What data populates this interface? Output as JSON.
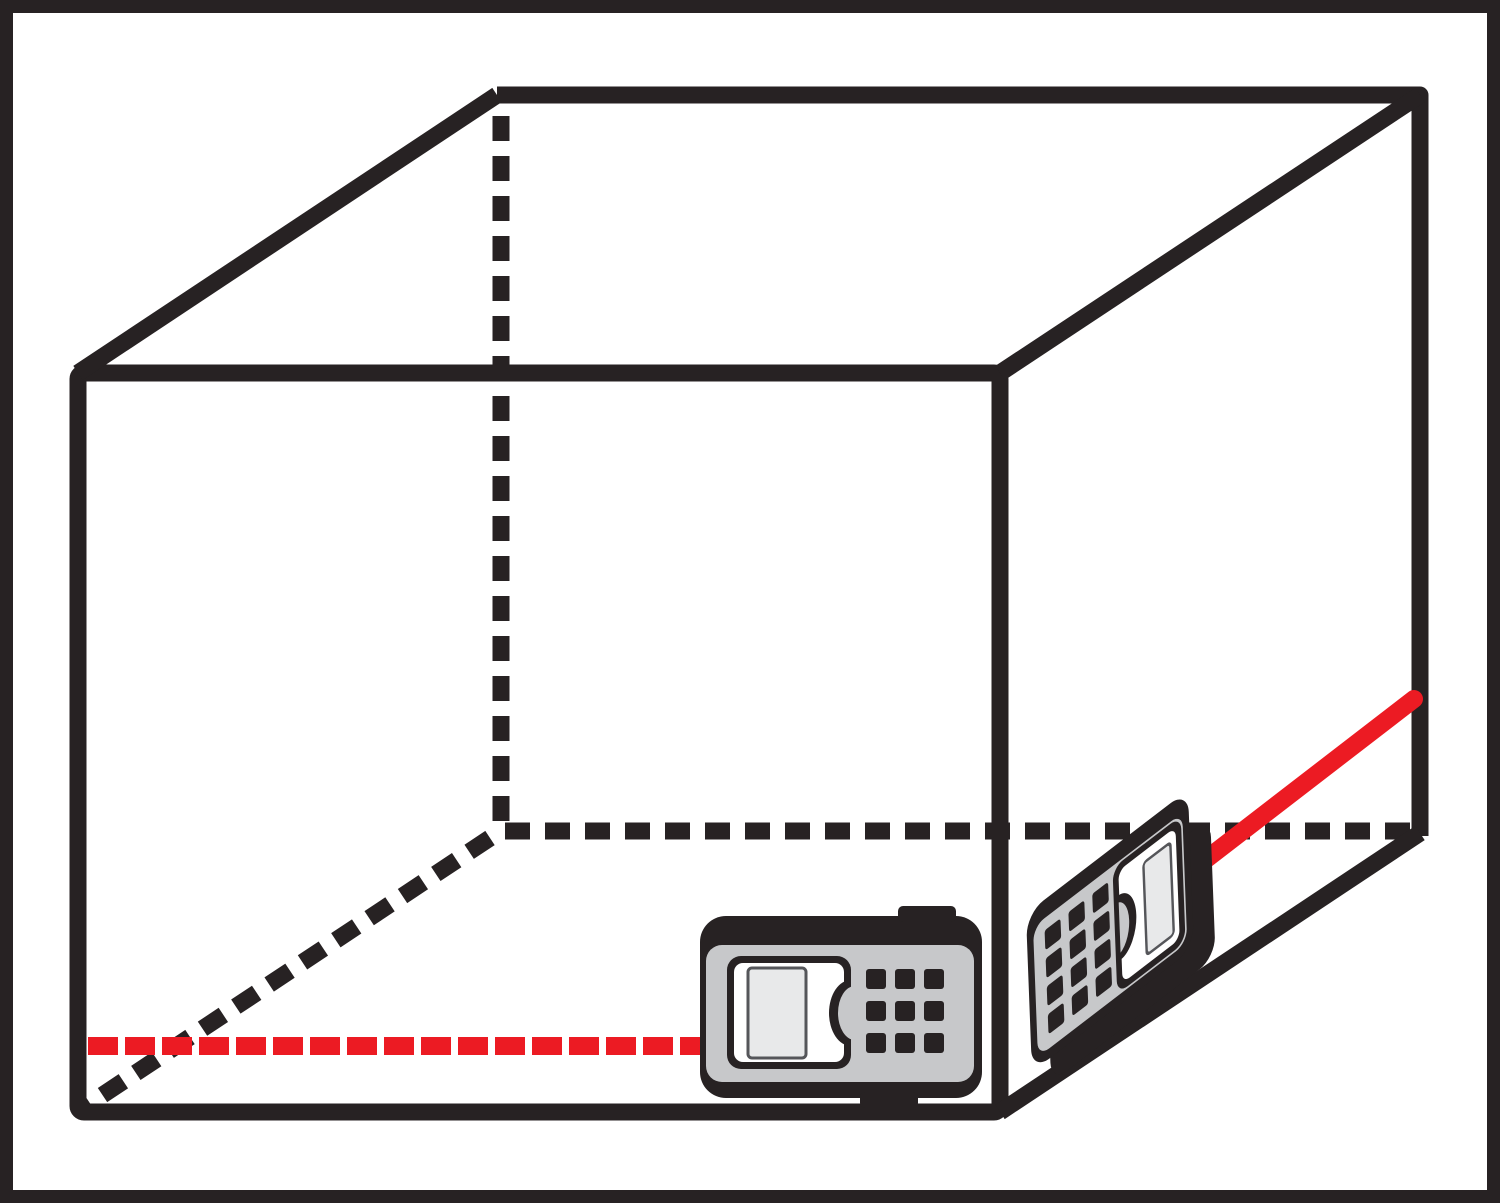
{
  "colors": {
    "background": "#ffffff",
    "line": "#272223",
    "laser": "#ec1b23",
    "device_body": "#c7c8ca",
    "device_panel": "#ffffff",
    "device_screen": "#e8e9ea",
    "screen_border": "#55565a"
  },
  "diagram": {
    "width": 1500,
    "height": 1203,
    "frame": {
      "inset": 6.5,
      "stroke": 13
    },
    "cube": {
      "stroke": 17,
      "dash": "25 15",
      "front_face": {
        "x": 78,
        "y": 373,
        "w": 922,
        "h": 739,
        "rx": 6
      },
      "back_edges_points": "497,95 1420,95 1420,836",
      "depth_edges": [
        [
          78,
          373,
          497,
          95
        ],
        [
          1000,
          373,
          1420,
          95
        ],
        [
          1000,
          1112,
          1420,
          833
        ]
      ],
      "hidden_edges": [
        [
          501,
          116,
          501,
          828
        ],
        [
          505,
          831,
          1413,
          831
        ],
        [
          490,
          838,
          86,
          1106
        ]
      ]
    },
    "lasers": {
      "floor_beam_dashed": {
        "x1": 88,
        "y1": 1046,
        "x2": 700,
        "y2": 1046,
        "stroke": 18,
        "dash": "30 7"
      },
      "wall_beam_solid": {
        "x1": 1200,
        "y1": 864,
        "x2": 1414,
        "y2": 699,
        "stroke": 18
      }
    },
    "devices": [
      {
        "name": "laser-distance-meter-front",
        "transform": "",
        "slab": null,
        "base": {
          "x": 700,
          "y": 916,
          "w": 282,
          "h": 182,
          "rx": 26
        },
        "bumps": [
          {
            "x": 898,
            "y": 906,
            "w": 58,
            "h": 16,
            "rx": 5
          },
          {
            "x": 860,
            "y": 1092,
            "w": 58,
            "h": 16,
            "rx": 5
          }
        ],
        "body": {
          "x": 706,
          "y": 945,
          "w": 268,
          "h": 137,
          "rx": 16
        },
        "keypad": {
          "x": 866,
          "y": 969,
          "cols": 3,
          "rows": 3,
          "key": 20,
          "gx": 9,
          "gy": 12
        },
        "display": {
          "frame": {
            "x": 727,
            "y": 956,
            "w": 124,
            "h": 113,
            "rx": 14
          },
          "panel": {
            "x": 734,
            "y": 963,
            "w": 110,
            "h": 99,
            "rx": 9
          },
          "notch_clip": {
            "x": 696,
            "y": 938,
            "w": 155,
            "h": 144
          },
          "notch_rim": {
            "cx": 851,
            "cy": 1013,
            "rx": 22,
            "ry": 33
          },
          "notch_fill": {
            "cx": 855,
            "cy": 1013,
            "rx": 17,
            "ry": 27
          },
          "screen": {
            "x": 748,
            "y": 968,
            "w": 58,
            "h": 90,
            "rx": 4
          }
        }
      },
      {
        "name": "laser-distance-meter-side",
        "transform": "matrix(0.794 -0.608 0.038 1 1033 927)",
        "slab": {
          "x": 15,
          "y": 25,
          "w": 207,
          "h": 140,
          "rx": 20
        },
        "base": {
          "x": -8,
          "y": -18,
          "w": 204,
          "h": 158,
          "rx": 22
        },
        "bumps": [],
        "body": {
          "x": 0,
          "y": 0,
          "w": 188,
          "h": 130,
          "rx": 14
        },
        "keypad": {
          "x": 14,
          "y": 12,
          "cols": 3,
          "rows": 4,
          "key": 20,
          "gx": 10,
          "gy": 8
        },
        "display": {
          "frame": {
            "x": 100,
            "y": 2,
            "w": 86,
            "h": 126,
            "rx": 13
          },
          "panel": {
            "x": 107,
            "y": 9,
            "w": 72,
            "h": 112,
            "rx": 9
          },
          "notch_clip": {
            "x": 106,
            "y": -20,
            "w": 100,
            "h": 170
          },
          "notch_rim": {
            "cx": 106,
            "cy": 65,
            "rx": 21,
            "ry": 32
          },
          "notch_fill": {
            "cx": 102,
            "cy": 65,
            "rx": 16,
            "ry": 26
          },
          "screen": {
            "x": 138,
            "y": 20,
            "w": 34,
            "h": 92,
            "rx": 4
          }
        }
      }
    ]
  }
}
